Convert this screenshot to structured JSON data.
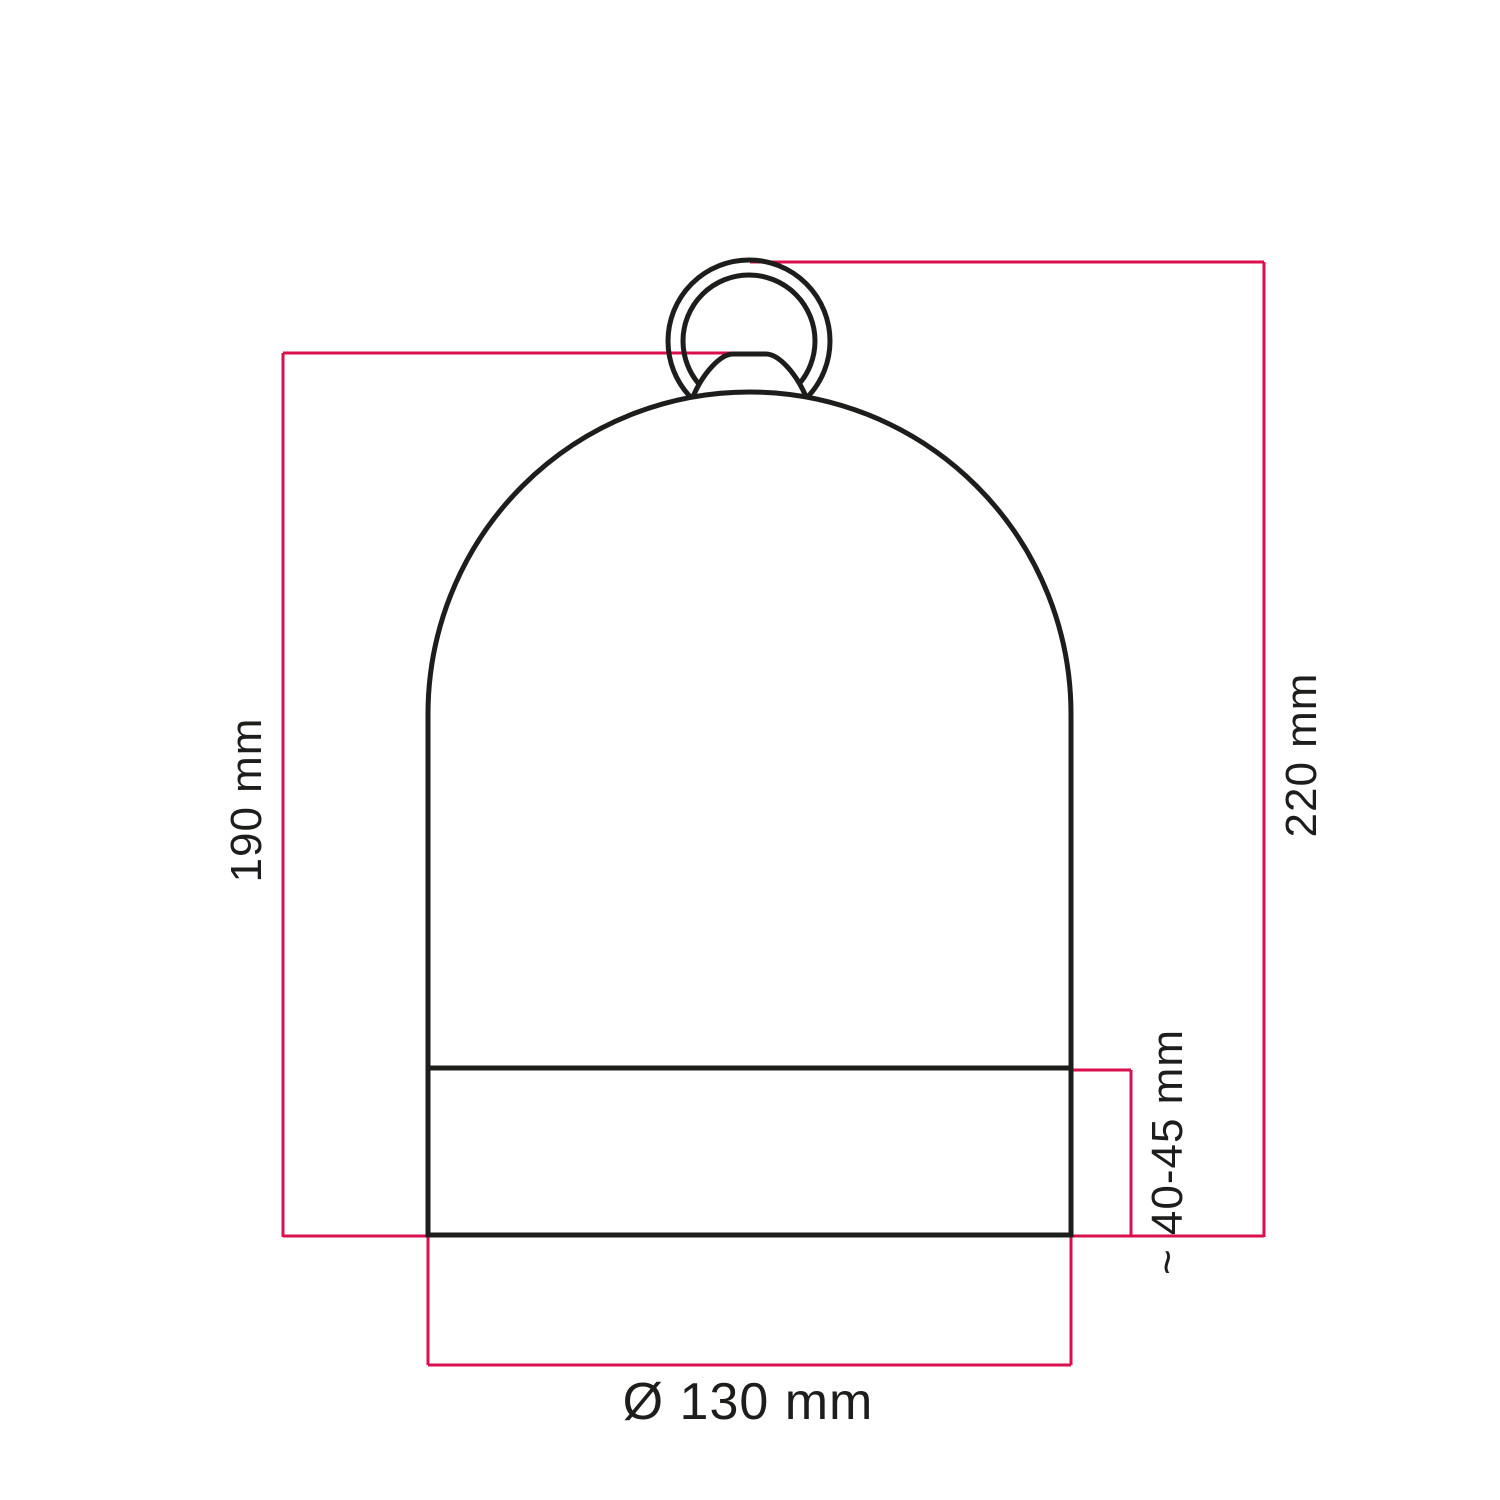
{
  "diagram": {
    "kind": "technical-dimension-drawing",
    "subject": "bell-shaped lampshade with hanging ring",
    "colors": {
      "outline": "#1d1d1b",
      "dimension": "#dc0f4e",
      "text": "#1d1d1b",
      "background": "#ffffff"
    },
    "labels": {
      "height_left": "190 mm",
      "height_right": "220 mm",
      "band_height": "~ 40-45 mm",
      "diameter": "Ø 130 mm"
    }
  }
}
